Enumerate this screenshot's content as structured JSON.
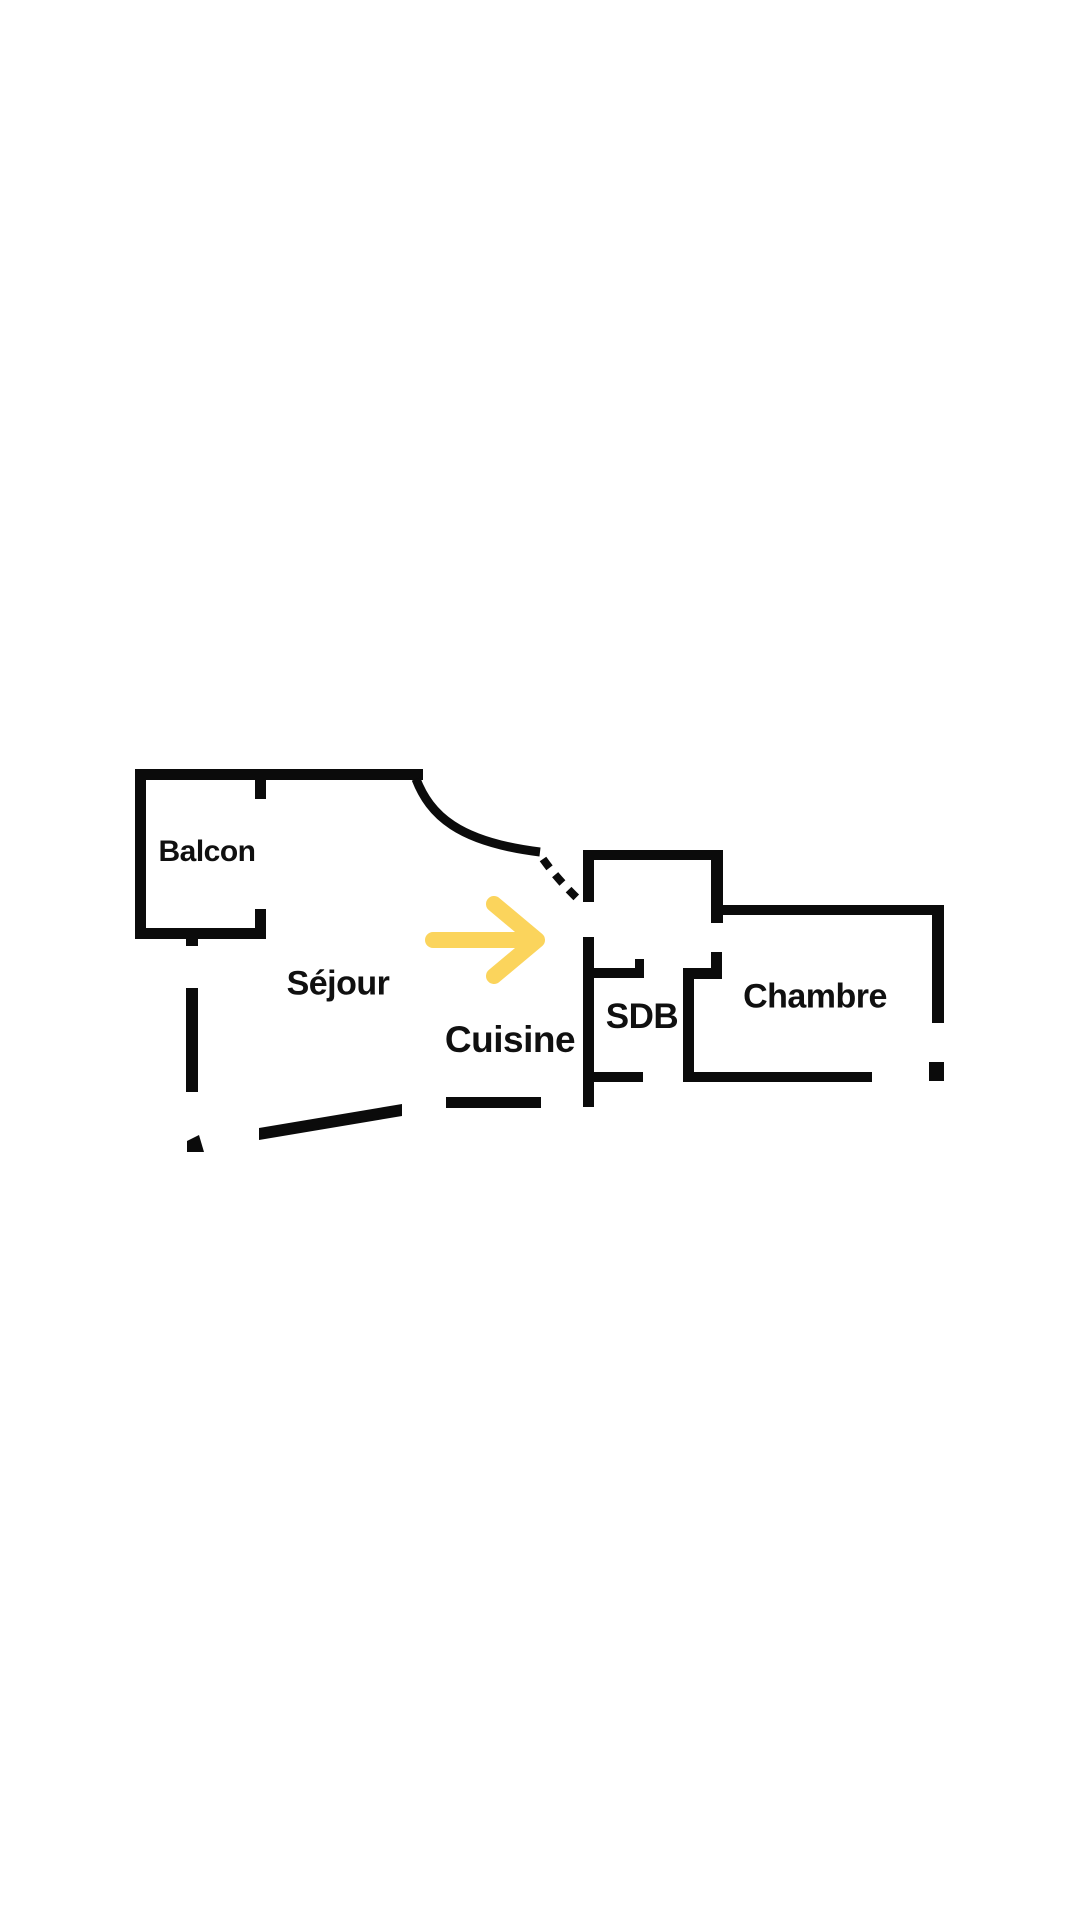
{
  "canvas": {
    "background": "#ffffff",
    "width": 1080,
    "height": 1920
  },
  "colors": {
    "wall": "#0b0b0b",
    "label": "#101010",
    "arrow": "#FBD45C"
  },
  "floor_plan": {
    "type": "apartment-floor-plan",
    "rooms": [
      {
        "id": "balcon",
        "label": "Balcon"
      },
      {
        "id": "sejour",
        "label": "Séjour"
      },
      {
        "id": "cuisine",
        "label": "Cuisine"
      },
      {
        "id": "sdb",
        "label": "SDB"
      },
      {
        "id": "chambre",
        "label": "Chambre"
      }
    ],
    "annotations": [
      {
        "id": "entrance-arrow",
        "type": "arrow",
        "direction": "right",
        "color": "#FBD45C"
      },
      {
        "id": "door-swing-arc",
        "type": "solid-arc"
      },
      {
        "id": "door-swing-dashed",
        "type": "dashed-arc"
      }
    ]
  }
}
